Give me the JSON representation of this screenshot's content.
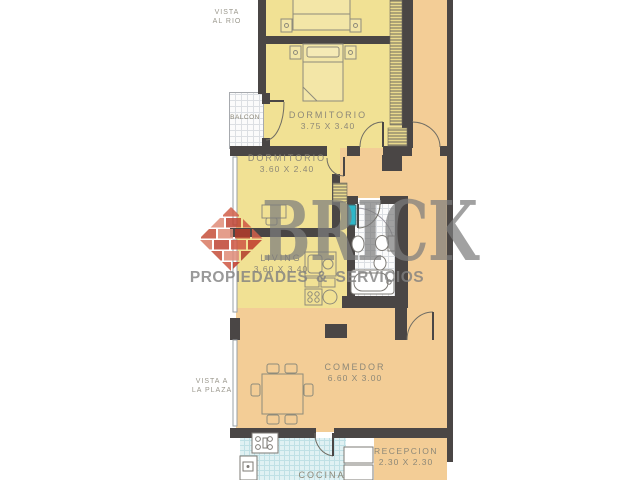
{
  "annotations": {
    "vista_rio_line1": "VISTA",
    "vista_rio_line2": "AL RIO",
    "vista_plaza_line1": "VISTA A",
    "vista_plaza_line2": "LA PLAZA"
  },
  "rooms": {
    "balcon": {
      "name": "BALCON"
    },
    "dormitorio1": {
      "name": "DORMITORIO",
      "dims": "3.75 X 3.40"
    },
    "dormitorio2": {
      "name": "DORMITORIO",
      "dims": "3.60 X 2.40"
    },
    "living": {
      "name": "LIVING",
      "dims": "3.60 X 3.40"
    },
    "comedor": {
      "name": "COMEDOR",
      "dims": "6.60 X 3.00"
    },
    "cocina": {
      "name": "COCINA"
    },
    "recepcion": {
      "name": "RECEPCION",
      "dims": "2.30 X 2.30"
    }
  },
  "watermark": {
    "brand": "BRICK",
    "tagline": "PROPIEDADES & SERVICIOS"
  },
  "colors": {
    "room_yellow": "#f1e194",
    "hall_orange": "#f3cd96",
    "wall": "#4a4645",
    "accent_teal": "#2fb6c8",
    "logo_red": "#c7473a",
    "watermark_gray": "#8f8f8f"
  }
}
